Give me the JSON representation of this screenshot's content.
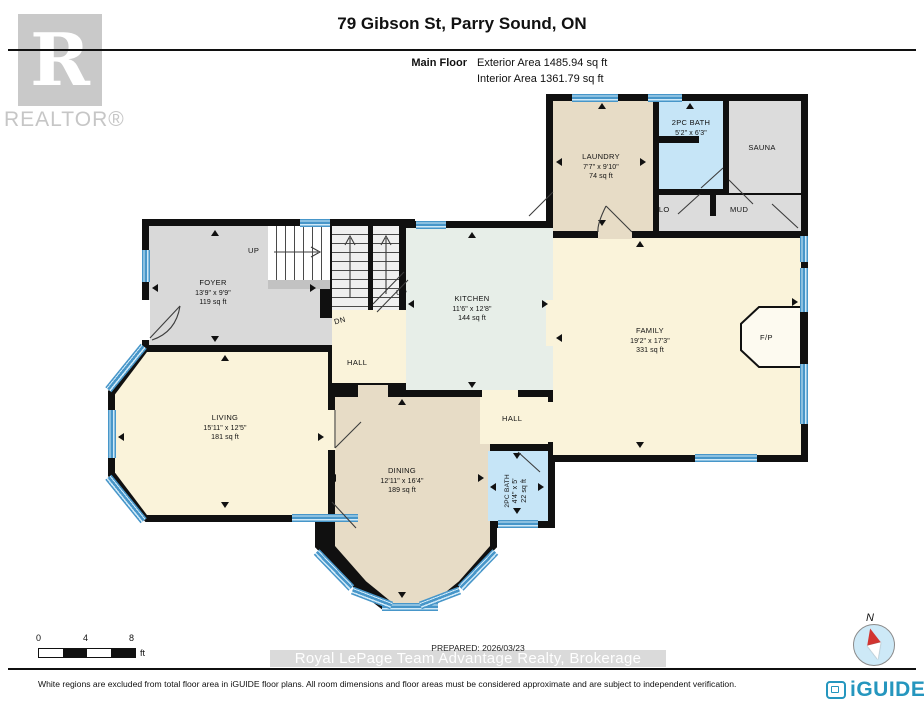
{
  "header": {
    "title": "79 Gibson St, Parry Sound, ON",
    "floor_label": "Main Floor",
    "exterior_area": "Exterior Area 1485.94 sq ft",
    "interior_area": "Interior Area 1361.79 sq ft"
  },
  "branding": {
    "realtor_monogram": "R",
    "realtor_label": "REALTOR®",
    "iguide_label": "iGUIDE"
  },
  "compass": {
    "north_label": "N"
  },
  "rooms": {
    "laundry": {
      "name": "LAUNDRY",
      "dims": "7'7\" x 9'10\"",
      "area": "74 sq ft"
    },
    "bath_upper": {
      "name": "2PC BATH",
      "dims": "5'2\" x 6'3\""
    },
    "sauna": {
      "name": "SAUNA"
    },
    "closet": {
      "name": "CLO"
    },
    "mud": {
      "name": "MUD"
    },
    "foyer": {
      "name": "FOYER",
      "dims": "13'9\" x 9'9\"",
      "area": "119 sq ft"
    },
    "kitchen": {
      "name": "KITCHEN",
      "dims": "11'6\" x 12'8\"",
      "area": "144 sq ft"
    },
    "family": {
      "name": "FAMILY",
      "dims": "19'2\" x 17'3\"",
      "area": "331 sq ft"
    },
    "living": {
      "name": "LIVING",
      "dims": "15'11\" x 12'5\"",
      "area": "181 sq ft"
    },
    "dining": {
      "name": "DINING",
      "dims": "12'11\" x 16'4\"",
      "area": "189 sq ft"
    },
    "hall_upper": {
      "name": "HALL"
    },
    "hall_lower": {
      "name": "HALL"
    },
    "bath_lower": {
      "name": "2PC BATH",
      "dims": "4'4\" x 5'",
      "area": "22 sq ft"
    },
    "fireplace": {
      "name": "F/P"
    }
  },
  "stairs": {
    "up_foyer": "UP",
    "up_main": "UP",
    "down": "DN"
  },
  "scale_bar": {
    "start": "0",
    "mid": "4",
    "end": "8",
    "unit": "ft"
  },
  "footer": {
    "prepared": "PREPARED: 2026/03/23",
    "brokerage": "Royal LePage Team Advantage Realty, Brokerage",
    "disclaimer": "White regions are excluded from total floor area in iGUIDE floor plans. All room dimensions and floor areas must be considered approximate and are subject to independent verification."
  }
}
